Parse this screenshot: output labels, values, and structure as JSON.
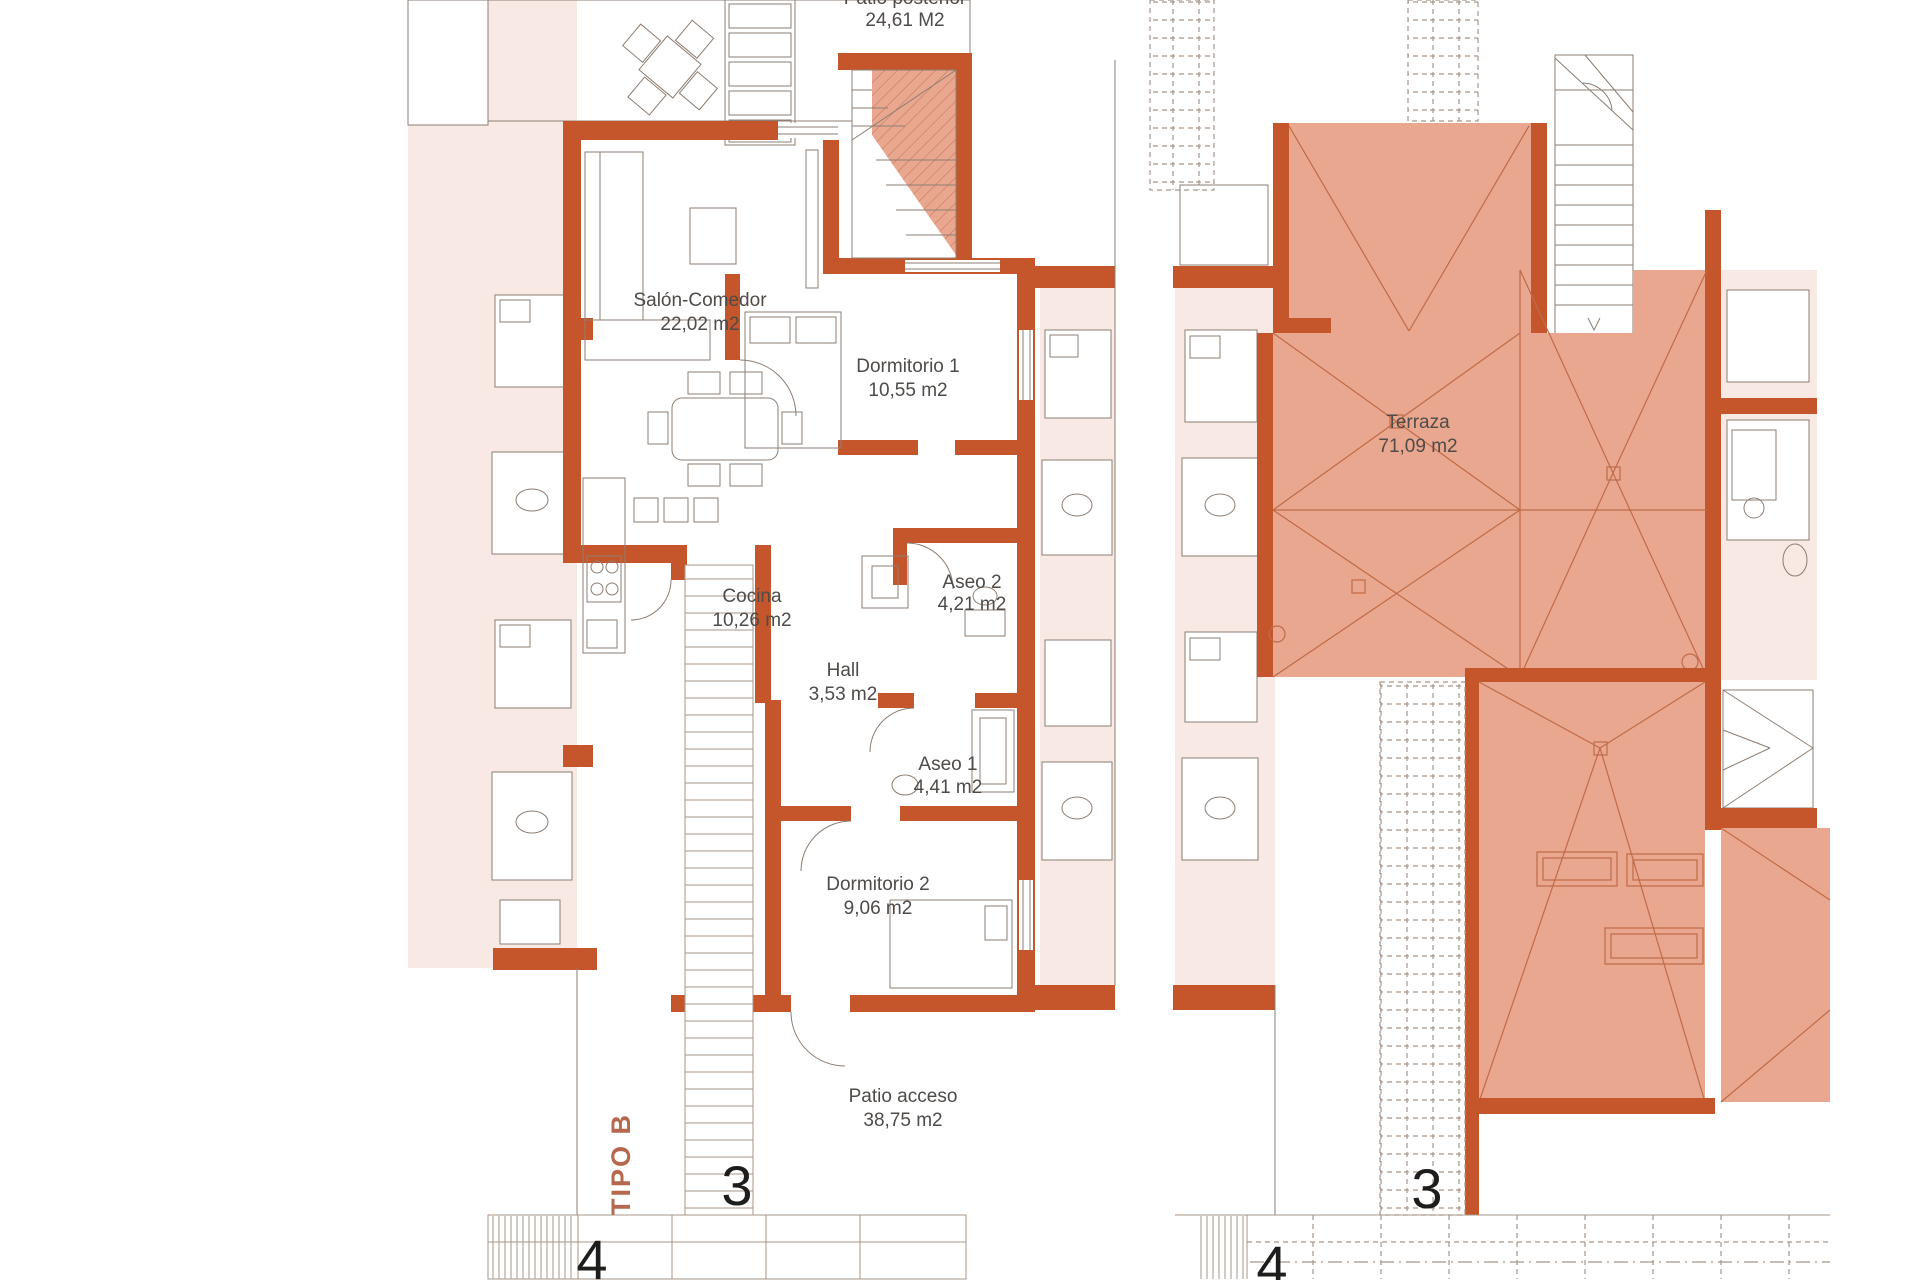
{
  "document": {
    "type_label": "TIPO B"
  },
  "colors": {
    "wall": "#c5562b",
    "roof": "#eaa78f",
    "tint": "#f8e9e4",
    "line": "#8d7d72",
    "hatch": "#a8968a",
    "ridge": "#bf6b47",
    "label": "#4e4b48",
    "number": "#1d1d1b",
    "type": "#b5684e"
  },
  "left_plan": {
    "unit_number": "3",
    "sidewalk_number": "4",
    "top_label": {
      "name": "Patio posterior",
      "area": "24,61 M2"
    },
    "rooms": {
      "salon": {
        "name": "Salón-Comedor",
        "area": "22,02 m2"
      },
      "dormitorio1": {
        "name": "Dormitorio 1",
        "area": "10,55 m2"
      },
      "cocina": {
        "name": "Cocina",
        "area": "10,26 m2"
      },
      "hall": {
        "name": "Hall",
        "area": "3,53 m2"
      },
      "aseo2": {
        "name": "Aseo 2",
        "area": "4,21 m2"
      },
      "aseo1": {
        "name": "Aseo 1",
        "area": "4,41 m2"
      },
      "dormitorio2": {
        "name": "Dormitorio 2",
        "area": "9,06 m2"
      },
      "patio": {
        "name": "Patio acceso",
        "area": "38,75 m2"
      }
    }
  },
  "right_plan": {
    "unit_number": "3",
    "sidewalk_number": "4",
    "rooms": {
      "terraza": {
        "name": "Terraza",
        "area": "71,09 m2"
      }
    }
  }
}
